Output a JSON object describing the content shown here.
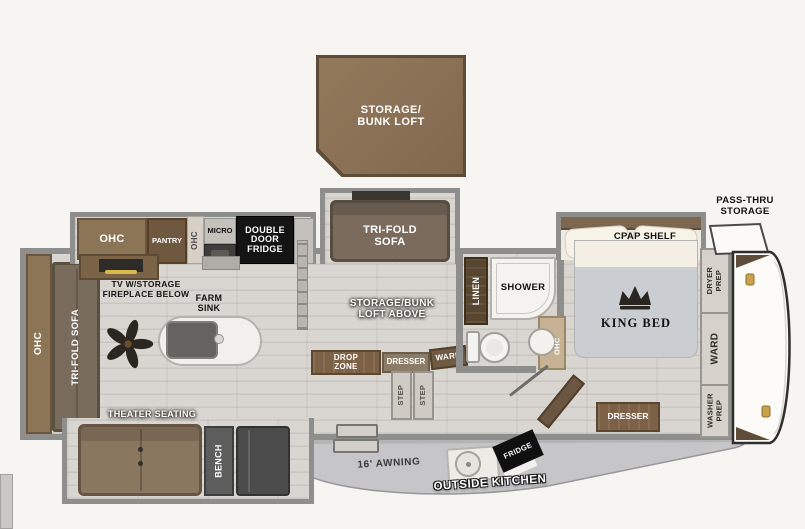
{
  "colors": {
    "wall_gray": "#8e8e8c",
    "cabinet_brown": "#8c7457",
    "dark_brown": "#6e5840",
    "loft_brown": "#8a7157",
    "floor": "#d9d6d1",
    "appliance_black": "#141414",
    "handle_gold": "#c9a24b"
  },
  "loft": {
    "label": "STORAGE/\nBUNK LOFT"
  },
  "exterior": {
    "pass_thru": "PASS-THRU\nSTORAGE",
    "awning": "16' AWNING",
    "outside_kitchen": "OUTSIDE KITCHEN",
    "fridge": "FRIDGE"
  },
  "kitchen": {
    "ohc": "OHC",
    "pantry": "PANTRY",
    "ohc_small": "OHC",
    "micro": "MICRO",
    "double_fridge": "DOUBLE\nDOOR\nFRIDGE",
    "tv": "TV W/STORAGE\nFIREPLACE BELOW",
    "farm_sink": "FARM\nSINK"
  },
  "rear": {
    "ohc": "OHC",
    "sofa": "TRI-FOLD SOFA"
  },
  "living": {
    "sofa": "TRI-FOLD\nSOFA",
    "loft_above": "STORAGE/BUNK\nLOFT ABOVE",
    "theater": "THEATER SEATING",
    "bench": "BENCH"
  },
  "mid": {
    "drop_zone": "DROP\nZONE",
    "dresser": "DRESSER",
    "ward": "WARD",
    "step": "STEP"
  },
  "bath": {
    "linen": "LINEN",
    "shower": "SHOWER",
    "ohc": "OHC"
  },
  "bedroom": {
    "cpap": "CPAP SHELF",
    "king_bed": "KING BED",
    "dresser": "DRESSER",
    "dryer_prep": "DRYER\nPREP",
    "ward": "WARD",
    "washer_prep": "WASHER\nPREP"
  }
}
